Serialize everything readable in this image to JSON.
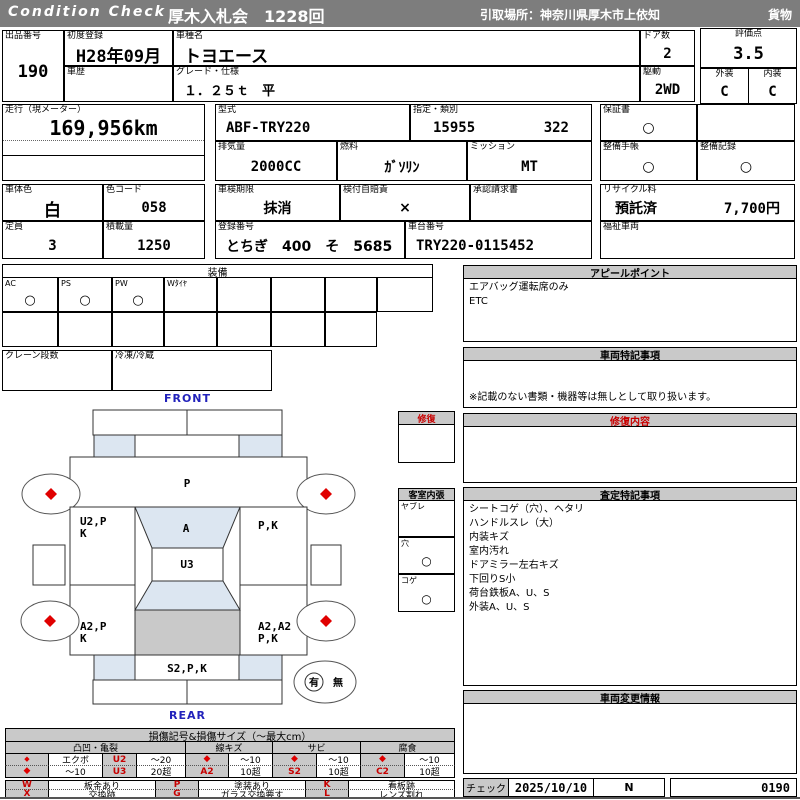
{
  "titlebar": {
    "brand": "Condition Check",
    "auction": "厚木入札会　1228回",
    "pickup": "引取場所：神奈川県厚木市上依知",
    "category": "貨物"
  },
  "fields": {
    "lot": {
      "label": "出品番号",
      "value": "190"
    },
    "first_reg": {
      "label": "初度登録",
      "value": "H28年09月"
    },
    "history": {
      "label": "車歴",
      "value": ""
    },
    "model_name": {
      "label": "車種名",
      "value": "トヨエース"
    },
    "grade": {
      "label": "グレード・仕様",
      "value": "１．２５ｔ　平"
    },
    "doors": {
      "label": "ドア数",
      "value": "2"
    },
    "drive": {
      "label": "駆動",
      "value": "2WD"
    },
    "score": {
      "label": "評価点",
      "value": "3.5"
    },
    "exterior": {
      "label": "外装",
      "value": "C"
    },
    "interior": {
      "label": "内装",
      "value": "C"
    },
    "mileage": {
      "label": "走行（現メーター）",
      "value": "169,956km"
    },
    "model_code": {
      "label": "型式",
      "value": "ABF-TRY220"
    },
    "designation": {
      "label": "指定・類別",
      "no1": "15955",
      "no2": "322"
    },
    "displacement": {
      "label": "排気量",
      "value": "2000CC"
    },
    "fuel": {
      "label": "燃料",
      "value": "ｶﾞｿﾘﾝ"
    },
    "mission": {
      "label": "ミッション",
      "value": "MT"
    },
    "warranty": {
      "label": "保証書",
      "value": "○"
    },
    "maintenance_book": {
      "label": "整備手帳",
      "value": "○"
    },
    "maintenance_record": {
      "label": "整備記録",
      "value": "○"
    },
    "body_color": {
      "label": "車体色",
      "value": "白"
    },
    "color_code": {
      "label": "色コード",
      "value": "058"
    },
    "inspection_expiry": {
      "label": "車検期限",
      "value": "抹消"
    },
    "liability_insurance": {
      "label": "検付自賠責",
      "value": "×"
    },
    "approval_request": {
      "label": "承認請求書",
      "value": ""
    },
    "recycle_fee": {
      "label": "リサイクル料",
      "status": "預託済",
      "amount": "7,700円"
    },
    "capacity": {
      "label": "定員",
      "value": "3"
    },
    "load_capacity": {
      "label": "積載量",
      "value": "1250"
    },
    "registration_no": {
      "label": "登録番号",
      "value": "とちぎ　400　そ　5685"
    },
    "chassis_no": {
      "label": "車台番号",
      "value": "TRY220-0115452"
    },
    "welfare_vehicle": {
      "label": "福祉車両",
      "value": ""
    }
  },
  "equipment": {
    "title": "装備",
    "items": [
      {
        "label": "AC",
        "value": "○"
      },
      {
        "label": "PS",
        "value": "○"
      },
      {
        "label": "PW",
        "value": "○"
      },
      {
        "label": "Wﾀｲﾔ",
        "value": ""
      }
    ],
    "crane": {
      "label": "クレーン段数",
      "value": ""
    },
    "reefer": {
      "label": "冷凍/冷蔵",
      "value": ""
    }
  },
  "diagram": {
    "front_label": "FRONT",
    "rear_label": "REAR",
    "zones": {
      "hood": "P",
      "left_door_1": "U2,P",
      "left_door_2": "K",
      "windshield": "A",
      "right_door": "P,K",
      "roof": "U3",
      "left_bed_1": "A2,P",
      "left_bed_2": "K",
      "right_bed_1": "A2,A2",
      "right_bed_2": "P,K",
      "rear_panel": "S2,P,K"
    },
    "repair_box": {
      "title": "修復"
    },
    "cabin_lining": {
      "title": "客室内張",
      "rows": [
        {
          "label": "ヤブレ",
          "value": ""
        },
        {
          "label": "穴",
          "value": "○"
        },
        {
          "label": "コゲ",
          "value": "○"
        }
      ]
    },
    "accident": {
      "yes": "有",
      "no": "無"
    }
  },
  "panels": {
    "appeal": {
      "title": "アピールポイント",
      "lines": [
        "エアバッグ運転席のみ",
        "ETC"
      ]
    },
    "special_notes": {
      "title": "車両特記事項",
      "footnote": "※記載のない書類・機器等は無しとして取り扱います。"
    },
    "repair_details": {
      "title": "修復内容"
    },
    "assessment_notes": {
      "title": "査定特記事項",
      "lines": [
        "シートコゲ（穴）、ヘタリ",
        "ハンドルスレ（大）",
        "内装キズ",
        "室内汚れ",
        "ドアミラー左右キズ",
        "下回りS小",
        "荷台鉄板A、U、S",
        "外装A、U、S"
      ]
    },
    "change_info": {
      "title": "車両変更情報"
    }
  },
  "legend": {
    "title": "損傷記号&損傷サイズ（～最大cm）",
    "groups": {
      "dent": "凸凹・亀裂",
      "scratch": "線キズ",
      "rust": "サビ",
      "corrosion": "腐食"
    },
    "dent": {
      "r1_name": "エクボ",
      "r1_code": "U2",
      "r1_size": "～20",
      "r2_size_a": "～10",
      "r2_code": "U3",
      "r2_size": "20超"
    },
    "scratch": {
      "r1_size": "～10",
      "r2_code": "A2",
      "r2_size": "10超"
    },
    "rust": {
      "r1_size": "～10",
      "r2_code": "S2",
      "r2_size": "10超"
    },
    "corrosion": {
      "r1_size": "～10",
      "r2_code": "C2",
      "r2_size": "10超"
    },
    "symbols": {
      "w": {
        "code": "W",
        "label": "板金あり"
      },
      "x": {
        "code": "X",
        "label": "交換跡"
      },
      "p": {
        "code": "P",
        "label": "塗装あり"
      },
      "g": {
        "code": "G",
        "label": "ガラス交換要す"
      },
      "k": {
        "code": "K",
        "label": "看板跡"
      },
      "l": {
        "code": "L",
        "label": "レンズ割れ"
      }
    }
  },
  "checker": {
    "label": "チェック",
    "date": "2025/10/10",
    "inspector": "N",
    "sheet_no": "0190"
  },
  "colors": {
    "accent_red": "#c80000",
    "marker_red": "#e00000",
    "header_gray": "#c9c9c9",
    "bar_gray": "#7d7d7d",
    "blue_label": "#2222bb",
    "panel_blue": "#dce6f1",
    "bed_gray": "#c9c9c9"
  }
}
